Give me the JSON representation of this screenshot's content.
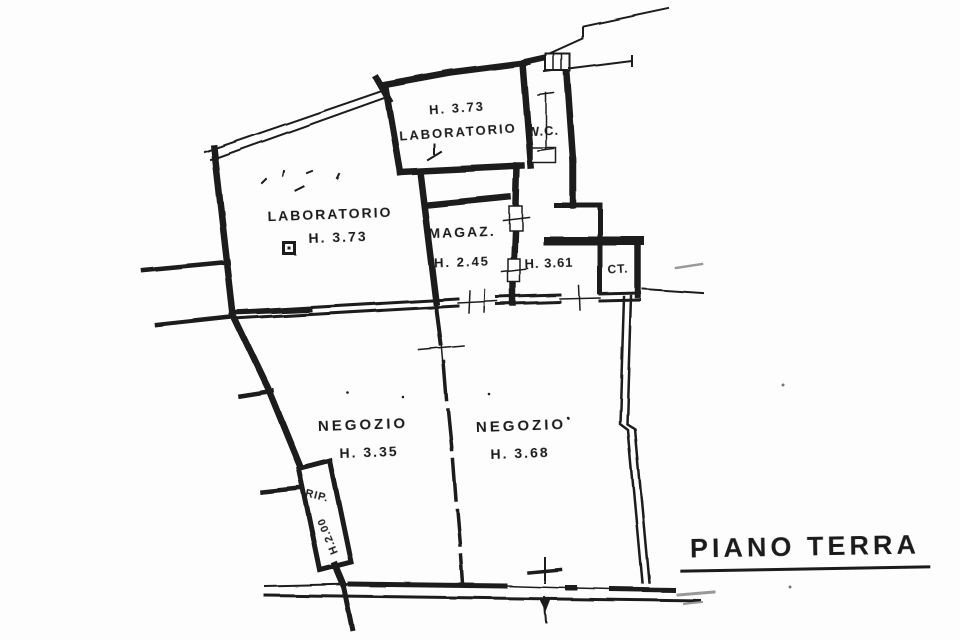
{
  "document": {
    "type": "scanned floor plan",
    "title": "PIANO TERRA"
  },
  "colors": {
    "ink": "#1d1d1d",
    "paper": "#fdfdfd",
    "faded_ink": "#999999"
  },
  "rooms": {
    "lab_top": {
      "height": "H. 3.73",
      "name": "LABORATORIO"
    },
    "wc": {
      "name": "W.C."
    },
    "lab_left": {
      "name": "LABORATORIO",
      "height": "H. 3.73"
    },
    "magaz": {
      "name": "MAGAZ.",
      "height": "H. 2.45"
    },
    "vano_361": {
      "height": "H. 3.61"
    },
    "ct": {
      "name": "CT."
    },
    "negozio_left": {
      "name": "NEGOZIO",
      "height": "H. 3.35"
    },
    "negozio_right": {
      "name": "NEGOZIO",
      "height": "H. 3.68"
    },
    "rip": {
      "name": "RIP.",
      "height": "H.2.00"
    }
  }
}
